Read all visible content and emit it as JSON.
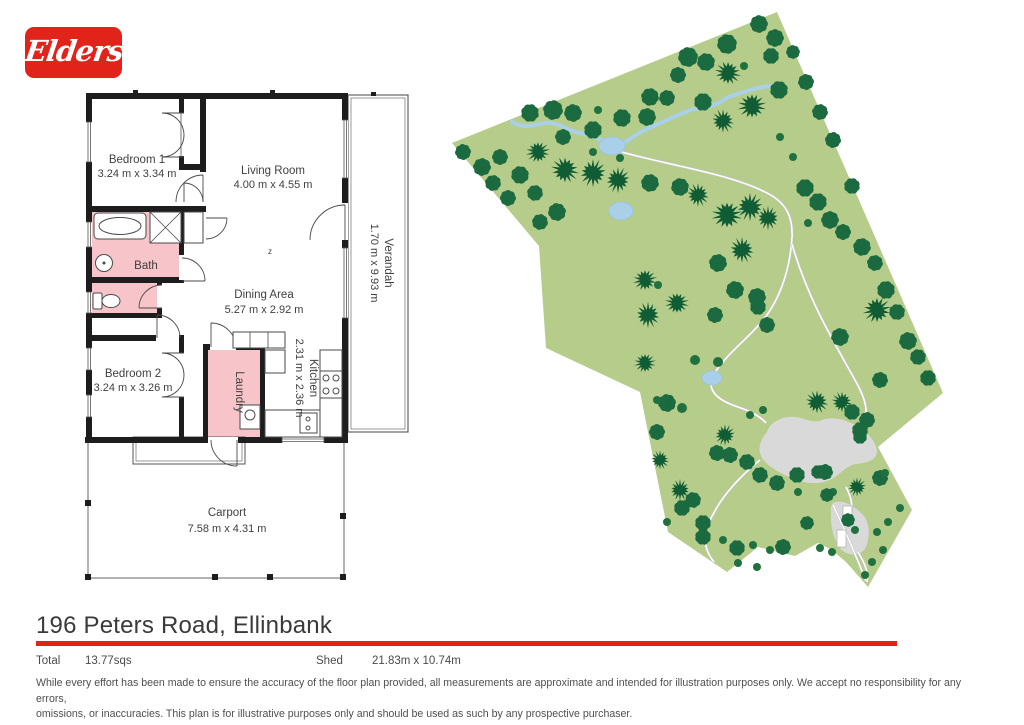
{
  "logo": {
    "text": "Elders",
    "bg_color": "#e2231a"
  },
  "footer": {
    "address": "196 Peters Road, Ellinbank",
    "accent_color": "#e0231c",
    "total_label": "Total",
    "total_value": "13.77sqs",
    "shed_label": "Shed",
    "shed_value": "21.83m x 10.74m",
    "disclaimer_line1": "While every effort has been made to ensure the accuracy of the floor plan provided, all measurements are approximate and intended for illustration purposes only. We accept no responsibility for any errors,",
    "disclaimer_line2": "omissions, or inaccuracies. This plan is for illustrative purposes only and should be used as such by any prospective purchaser."
  },
  "floorplan": {
    "labels": {
      "bedroom1": {
        "name": "Bedroom 1",
        "dims": "3.24 m x 3.34 m"
      },
      "living": {
        "name": "Living Room",
        "dims": "4.00 m x 4.55 m"
      },
      "bath": {
        "name": "Bath"
      },
      "dining": {
        "name": "Dining Area",
        "dims": "5.27 m x 2.92 m"
      },
      "bedroom2": {
        "name": "Bedroom 2",
        "dims": "3.24 m x 3.26 m"
      },
      "laundry": {
        "name": "Laundry"
      },
      "kitchen": {
        "name": "Kitchen",
        "dims": "2.31 m x 2.36 m"
      },
      "verandah": {
        "name": "Verandah",
        "dims": "1.70 m x 9.93 m"
      },
      "carport": {
        "name": "Carport",
        "dims": "7.58 m x 4.31 m"
      },
      "fan_symbol": "z"
    },
    "colors": {
      "wall": "#1d1d1d",
      "wet_area": "#f6c4c9",
      "fixture_stroke": "#4a4a4a"
    }
  },
  "site_map": {
    "colors": {
      "land": "#b5cc8b",
      "tree_fluffy": "#1b6a40",
      "tree_spiky": "#0f5c35",
      "tree_dot": "#20713f",
      "water": "#aacfe9",
      "water_edge": "#9cc3e0",
      "clearing": "#d9d9d9",
      "path": "#ffffff",
      "path_edge": "#c6c6c6",
      "building": "#ffffff",
      "building_edge": "#b5b5b5"
    },
    "outline": [
      [
        452,
        143
      ],
      [
        777,
        12
      ],
      [
        943,
        393
      ],
      [
        878,
        447
      ],
      [
        912,
        510
      ],
      [
        868,
        587
      ],
      [
        846,
        562
      ],
      [
        832,
        550
      ],
      [
        818,
        543
      ],
      [
        795,
        556
      ],
      [
        758,
        547
      ],
      [
        727,
        572
      ],
      [
        668,
        532
      ],
      [
        640,
        392
      ],
      [
        546,
        348
      ],
      [
        539,
        246
      ]
    ],
    "creek": "M512,122 C524,129 533,125 545,123 C557,121 567,131 580,133 C592,135 600,140 611,144 C622,148 630,137 645,130 C660,123 673,117 688,111 C700,106 712,108 722,101 C732,94 746,92 757,88 L770,86",
    "ponds": [
      [
        612,
        146,
        13,
        9
      ],
      [
        621,
        211,
        12,
        9
      ],
      [
        712,
        378,
        10,
        7
      ]
    ],
    "clearings": [
      "M767,432 C770,422 782,416 795,417 C806,418 812,424 822,420 C832,416 846,419 858,427 C868,433 876,441 877,451 C877,459 869,463 856,464 C847,465 842,473 832,479 C820,485 806,484 795,479 C784,475 770,469 762,458 C757,449 760,440 767,432 Z",
      "M835,502 C845,500 856,507 864,516 C870,524 870,537 866,547 C862,555 851,557 843,551 C836,545 831,531 831,518 C831,509 830,504 835,502 Z"
    ],
    "paths": [
      "M615,150 C660,164 725,172 765,192 C786,202 793,216 792,238 C790,268 781,297 764,319 C750,337 727,353 714,374 C706,388 714,399 738,407 C750,411 760,416 766,423",
      "M792,244 C808,300 834,342 855,380 C864,396 867,406 866,417",
      "M846,487 C851,496 853,505 851,514",
      "M858,552 C864,562 869,572 867,582",
      "M833,505 C843,526 855,553 866,581",
      "M760,460 C738,478 718,500 708,525 C702,540 706,552 714,562"
    ],
    "buildings": [
      [
        837,
        530,
        9,
        17
      ],
      [
        843,
        506,
        9,
        11
      ]
    ],
    "trees": [
      [
        688,
        57,
        10,
        "f"
      ],
      [
        706,
        62,
        9,
        "f"
      ],
      [
        727,
        44,
        10,
        "f"
      ],
      [
        759,
        24,
        9,
        "f"
      ],
      [
        775,
        38,
        9,
        "f"
      ],
      [
        771,
        56,
        8,
        "f"
      ],
      [
        779,
        90,
        9,
        "f"
      ],
      [
        728,
        73,
        12,
        "s"
      ],
      [
        752,
        106,
        13,
        "s"
      ],
      [
        703,
        102,
        9,
        "f"
      ],
      [
        723,
        121,
        11,
        "s"
      ],
      [
        650,
        97,
        9,
        "f"
      ],
      [
        667,
        98,
        8,
        "f"
      ],
      [
        678,
        75,
        8,
        "f"
      ],
      [
        744,
        66,
        4,
        "d"
      ],
      [
        622,
        118,
        9,
        "f"
      ],
      [
        647,
        117,
        9,
        "f"
      ],
      [
        598,
        110,
        4,
        "d"
      ],
      [
        553,
        110,
        10,
        "f"
      ],
      [
        573,
        113,
        9,
        "f"
      ],
      [
        593,
        130,
        9,
        "f"
      ],
      [
        563,
        137,
        8,
        "f"
      ],
      [
        530,
        113,
        9,
        "f"
      ],
      [
        620,
        158,
        4,
        "d"
      ],
      [
        593,
        152,
        4,
        "d"
      ],
      [
        463,
        152,
        8,
        "f"
      ],
      [
        482,
        167,
        9,
        "f"
      ],
      [
        500,
        157,
        8,
        "f"
      ],
      [
        493,
        183,
        8,
        "f"
      ],
      [
        520,
        175,
        9,
        "f"
      ],
      [
        508,
        198,
        8,
        "f"
      ],
      [
        535,
        193,
        8,
        "f"
      ],
      [
        557,
        212,
        9,
        "f"
      ],
      [
        540,
        222,
        8,
        "f"
      ],
      [
        538,
        152,
        11,
        "s"
      ],
      [
        565,
        170,
        13,
        "s"
      ],
      [
        593,
        173,
        13,
        "s"
      ],
      [
        618,
        180,
        12,
        "s"
      ],
      [
        650,
        183,
        9,
        "f"
      ],
      [
        680,
        187,
        9,
        "f"
      ],
      [
        698,
        195,
        11,
        "s"
      ],
      [
        727,
        215,
        14,
        "s"
      ],
      [
        750,
        207,
        13,
        "s"
      ],
      [
        768,
        218,
        11,
        "s"
      ],
      [
        805,
        188,
        9,
        "f"
      ],
      [
        818,
        202,
        9,
        "f"
      ],
      [
        830,
        220,
        9,
        "f"
      ],
      [
        808,
        223,
        4,
        "d"
      ],
      [
        843,
        232,
        8,
        "f"
      ],
      [
        780,
        137,
        4,
        "d"
      ],
      [
        793,
        157,
        4,
        "d"
      ],
      [
        852,
        186,
        8,
        "f"
      ],
      [
        793,
        52,
        7,
        "f"
      ],
      [
        806,
        82,
        8,
        "f"
      ],
      [
        820,
        112,
        8,
        "f"
      ],
      [
        833,
        140,
        8,
        "f"
      ],
      [
        862,
        247,
        9,
        "f"
      ],
      [
        875,
        263,
        8,
        "f"
      ],
      [
        886,
        290,
        9,
        "f"
      ],
      [
        897,
        312,
        8,
        "f"
      ],
      [
        908,
        341,
        9,
        "f"
      ],
      [
        918,
        357,
        8,
        "f"
      ],
      [
        928,
        378,
        8,
        "f"
      ],
      [
        742,
        250,
        12,
        "s"
      ],
      [
        718,
        263,
        9,
        "f"
      ],
      [
        735,
        290,
        9,
        "f"
      ],
      [
        645,
        280,
        11,
        "s"
      ],
      [
        658,
        285,
        4,
        "d"
      ],
      [
        677,
        303,
        11,
        "s"
      ],
      [
        757,
        297,
        9,
        "f"
      ],
      [
        648,
        315,
        12,
        "s"
      ],
      [
        645,
        363,
        10,
        "s"
      ],
      [
        715,
        315,
        8,
        "f"
      ],
      [
        758,
        307,
        8,
        "f"
      ],
      [
        767,
        325,
        8,
        "f"
      ],
      [
        877,
        310,
        13,
        "s"
      ],
      [
        840,
        337,
        9,
        "f"
      ],
      [
        880,
        380,
        8,
        "f"
      ],
      [
        695,
        360,
        5,
        "d"
      ],
      [
        718,
        362,
        5,
        "d"
      ],
      [
        667,
        403,
        9,
        "f"
      ],
      [
        682,
        408,
        5,
        "d"
      ],
      [
        817,
        402,
        11,
        "s"
      ],
      [
        842,
        402,
        10,
        "s"
      ],
      [
        852,
        412,
        8,
        "f"
      ],
      [
        860,
        430,
        8,
        "f"
      ],
      [
        657,
        400,
        4,
        "d"
      ],
      [
        750,
        415,
        4,
        "d"
      ],
      [
        763,
        410,
        4,
        "d"
      ],
      [
        725,
        435,
        10,
        "s"
      ],
      [
        730,
        455,
        8,
        "f"
      ],
      [
        717,
        453,
        8,
        "f"
      ],
      [
        747,
        462,
        8,
        "f"
      ],
      [
        760,
        475,
        8,
        "f"
      ],
      [
        777,
        483,
        8,
        "f"
      ],
      [
        797,
        475,
        8,
        "f"
      ],
      [
        825,
        472,
        8,
        "f"
      ],
      [
        833,
        492,
        4,
        "d"
      ],
      [
        798,
        492,
        4,
        "d"
      ],
      [
        680,
        490,
        10,
        "s"
      ],
      [
        682,
        508,
        8,
        "f"
      ],
      [
        667,
        522,
        4,
        "d"
      ],
      [
        703,
        537,
        8,
        "f"
      ],
      [
        723,
        540,
        4,
        "d"
      ],
      [
        737,
        548,
        8,
        "f"
      ],
      [
        753,
        545,
        4,
        "d"
      ],
      [
        770,
        550,
        4,
        "d"
      ],
      [
        783,
        547,
        8,
        "f"
      ],
      [
        738,
        563,
        4,
        "d"
      ],
      [
        757,
        567,
        4,
        "d"
      ],
      [
        703,
        523,
        8,
        "f"
      ],
      [
        693,
        500,
        8,
        "f"
      ],
      [
        657,
        432,
        8,
        "f"
      ],
      [
        660,
        460,
        9,
        "s"
      ],
      [
        880,
        478,
        8,
        "f"
      ],
      [
        885,
        473,
        4,
        "d"
      ],
      [
        900,
        508,
        4,
        "d"
      ],
      [
        888,
        522,
        4,
        "d"
      ],
      [
        877,
        532,
        4,
        "d"
      ],
      [
        883,
        550,
        4,
        "d"
      ],
      [
        872,
        562,
        4,
        "d"
      ],
      [
        865,
        575,
        4,
        "d"
      ],
      [
        855,
        530,
        4,
        "d"
      ],
      [
        848,
        520,
        7,
        "f"
      ],
      [
        832,
        552,
        4,
        "d"
      ],
      [
        820,
        548,
        4,
        "d"
      ],
      [
        807,
        523,
        7,
        "f"
      ],
      [
        857,
        487,
        9,
        "s"
      ],
      [
        818,
        472,
        7,
        "f"
      ],
      [
        827,
        495,
        7,
        "f"
      ],
      [
        867,
        420,
        8,
        "f"
      ],
      [
        860,
        437,
        7,
        "f"
      ]
    ]
  }
}
